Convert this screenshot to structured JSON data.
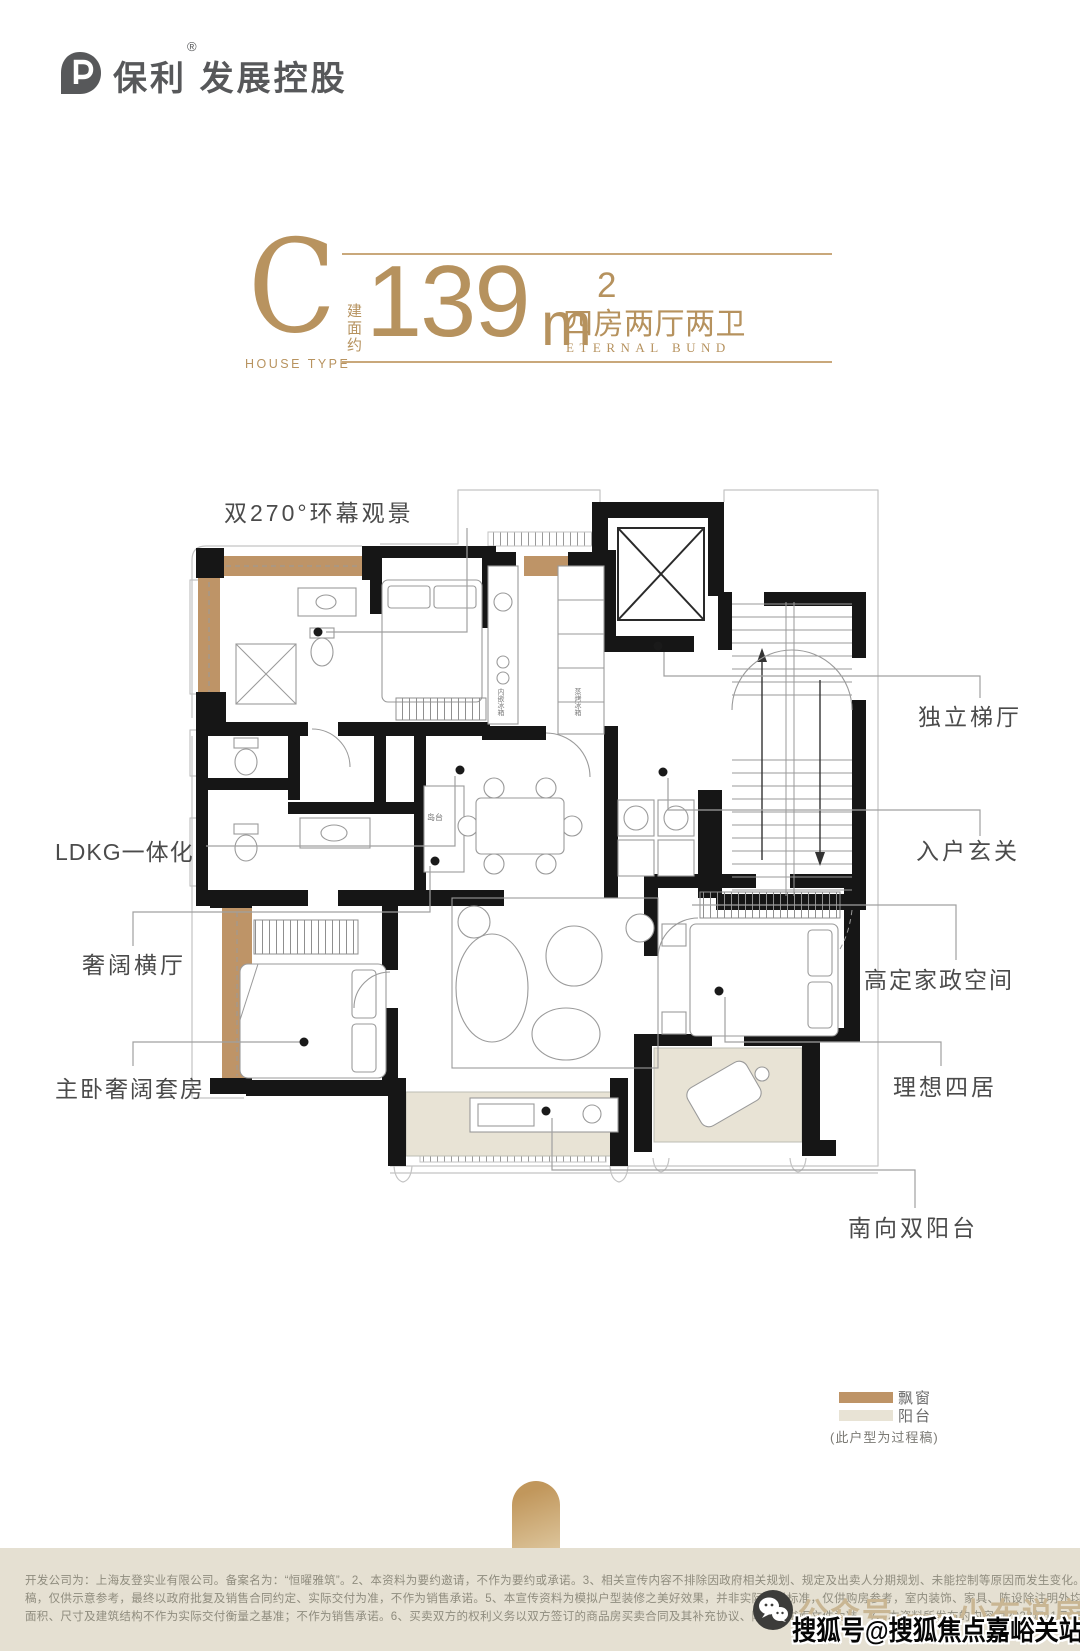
{
  "brand": {
    "name_cn": "保利",
    "reg": "®",
    "suffix": "发展控股"
  },
  "title": {
    "letter": "C",
    "letter_label": "HOUSE TYPE",
    "area_prefix": "建面约",
    "area_number": "139",
    "area_unit": "m",
    "area_exp": "2",
    "layout_cn": "四房两厅两卫",
    "layout_en": "ETERNAL BUND"
  },
  "callouts": {
    "panorama": "双270°环幕观景",
    "ldkg": "LDKG一体化",
    "grand_hall": "奢阔横厅",
    "master_suite": "主卧奢阔套房",
    "lift_lobby": "独立梯厅",
    "foyer": "入户玄关",
    "housekeeping": "高定家政空间",
    "four_bedrooms": "理想四居",
    "south_balcony": "南向双阳台"
  },
  "plan_annotations": {
    "island": "岛台",
    "appliance_left": "内嵌冰箱",
    "appliance_right": "蒸烤冰箱"
  },
  "legend": {
    "bay_window_label": "飘窗",
    "balcony_label": "阳台",
    "note": "(此户型为过程稿)",
    "bay_window_color": "#be9467",
    "balcony_color": "#e8e3d5"
  },
  "footer": {
    "line1": "开发公司为：上海友登实业有限公司。备案名为：“恒曜雅筑”。2、本资料为要约邀请，不作为要约或承诺。3、相关宣传内容不排除因政府相关规划、规定及出卖人分期规划、未能控制等原因而发生变化。4、本宣传资料所涉及的户型为过程",
    "line2": "稿，仅供示意参考，最终以政府批复及销售合同约定、实际交付为准，不作为销售承诺。5、本宣传资料为模拟户型装修之美好效果，并非实际交付标准，仅供购房参考，室内装饰、家具、陈设除注明外均不属于交付范围，室内所有",
    "line3": "面积、尺寸及建筑结构不作为实际交付衡量之基准；不作为销售承诺。6、买卖双方的权利义务以双方签订的商品房买卖合同及其补充协议、附件等书面文件为准。7、本资料所发布的内容为2023年11月25日前的信息，敬请留意最新资料。"
  },
  "watermarks": {
    "wechat_account": "公众号——小布说房",
    "sohu_account": "搜狐号@搜狐焦点嘉峪关站"
  },
  "colors": {
    "gold": "#b6925e",
    "rule_gold": "#c9a87b",
    "wall": "#161616",
    "footer_bg": "#e5e0d2"
  }
}
